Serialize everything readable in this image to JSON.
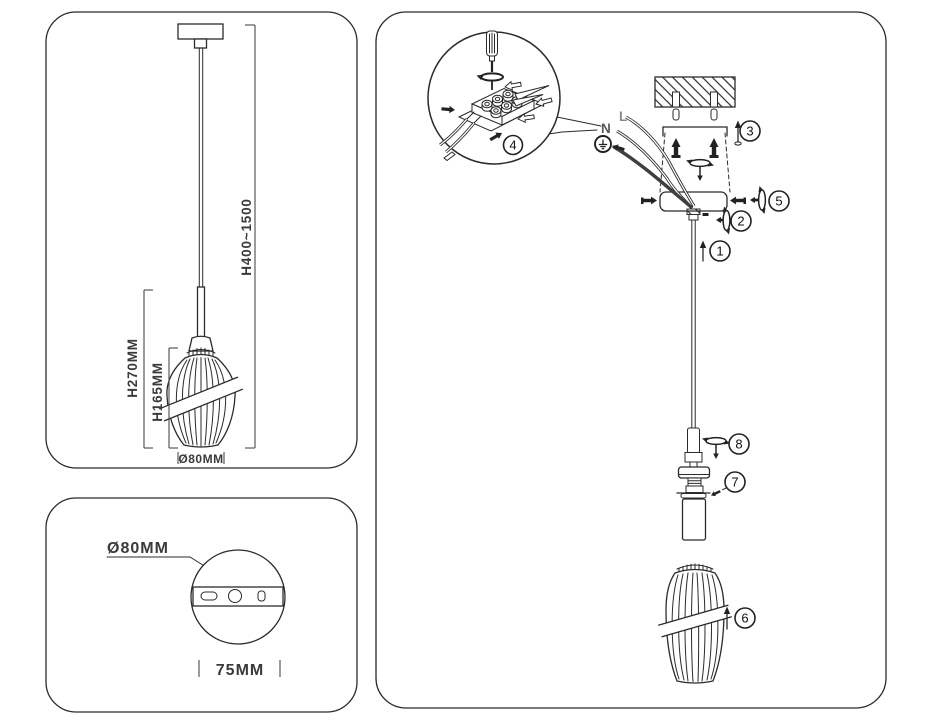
{
  "product_diagram": {
    "overall_drop_label": "H400~1500",
    "fixture_height_label": "H270MM",
    "shade_height_label": "H165MM",
    "shade_diameter_label": "Ø80MM"
  },
  "canopy_detail": {
    "canopy_diameter_label": "Ø80MM",
    "mounting_hole_spacing_label": "75MM"
  },
  "installation": {
    "wire_neutral_label": "N",
    "wire_live_label": "L",
    "ground_icon": "earth-ground-symbol",
    "steps": [
      "1",
      "2",
      "3",
      "4",
      "5",
      "6",
      "7",
      "8"
    ]
  }
}
